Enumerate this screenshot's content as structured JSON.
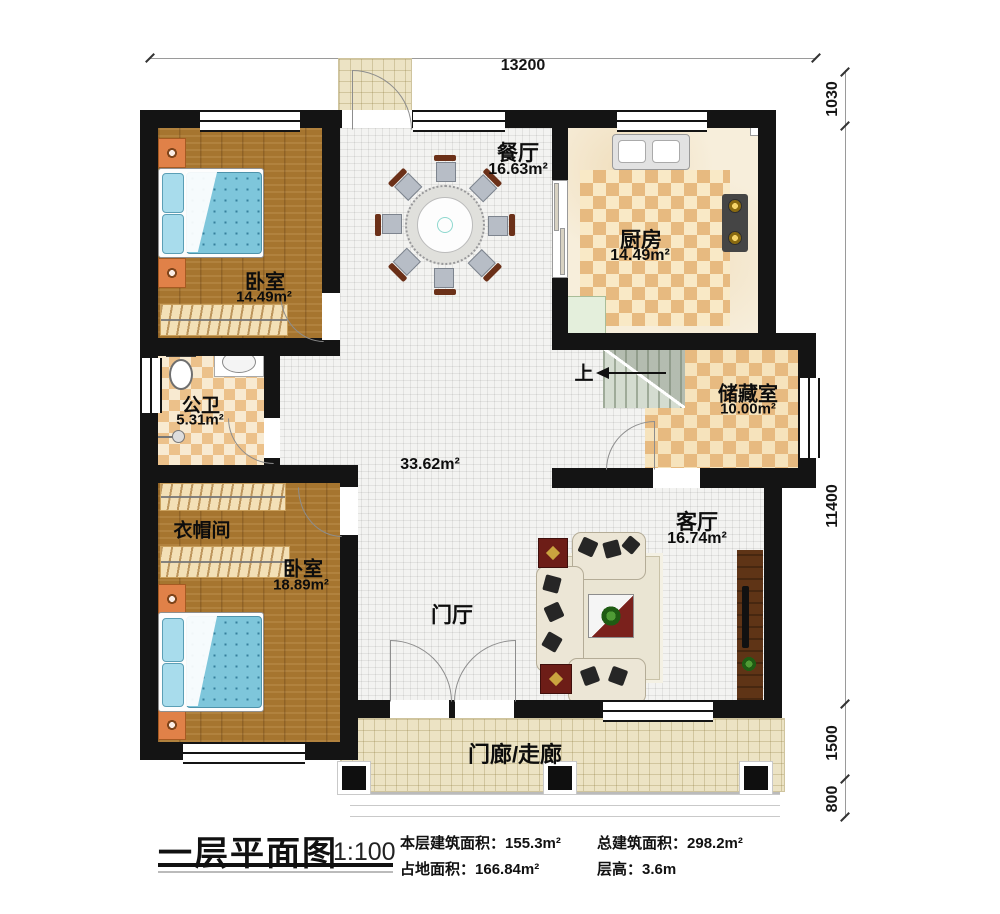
{
  "rooms": {
    "dining": {
      "name": "餐厅",
      "area": "16.63m²"
    },
    "kitchen": {
      "name": "厨房",
      "area": "14.49m²"
    },
    "bedroom1": {
      "name": "卧室",
      "area": "14.49m²"
    },
    "bathroom": {
      "name": "公卫",
      "area": "5.31m²"
    },
    "cloakroom": {
      "name": "衣帽间"
    },
    "bedroom2": {
      "name": "卧室",
      "area": "18.89m²"
    },
    "storage": {
      "name": "储藏室",
      "area": "10.00m²"
    },
    "living": {
      "name": "客厅",
      "area": "16.74m²"
    },
    "hall": {
      "area": "33.62m²"
    },
    "foyer": {
      "name": "门厅"
    },
    "porch": {
      "name": "门廊/走廊"
    },
    "stairs": {
      "up": "上"
    }
  },
  "dimensions": {
    "top": "13200",
    "right": [
      "1030",
      "11400",
      "1500",
      "800"
    ]
  },
  "titleblock": {
    "title": "一层平面图",
    "scale": "1:100",
    "stats": [
      {
        "label": "本层建筑面积：",
        "value": "155.3m²"
      },
      {
        "label": "总建筑面积：",
        "value": "298.2m²"
      },
      {
        "label": "占地面积：",
        "value": "166.84m²"
      },
      {
        "label": "层高：",
        "value": "3.6m"
      }
    ]
  },
  "colors": {
    "wall": "#141414",
    "wood_floor": "#a6752f",
    "checker_dark": "#e7ba80",
    "checker_light": "#f9e9c6",
    "hall_tile": "#f3f3f1",
    "porch_tile": "#ece3c4",
    "bed_blue": "#7ec6db",
    "accent_red": "#6d1d17"
  }
}
